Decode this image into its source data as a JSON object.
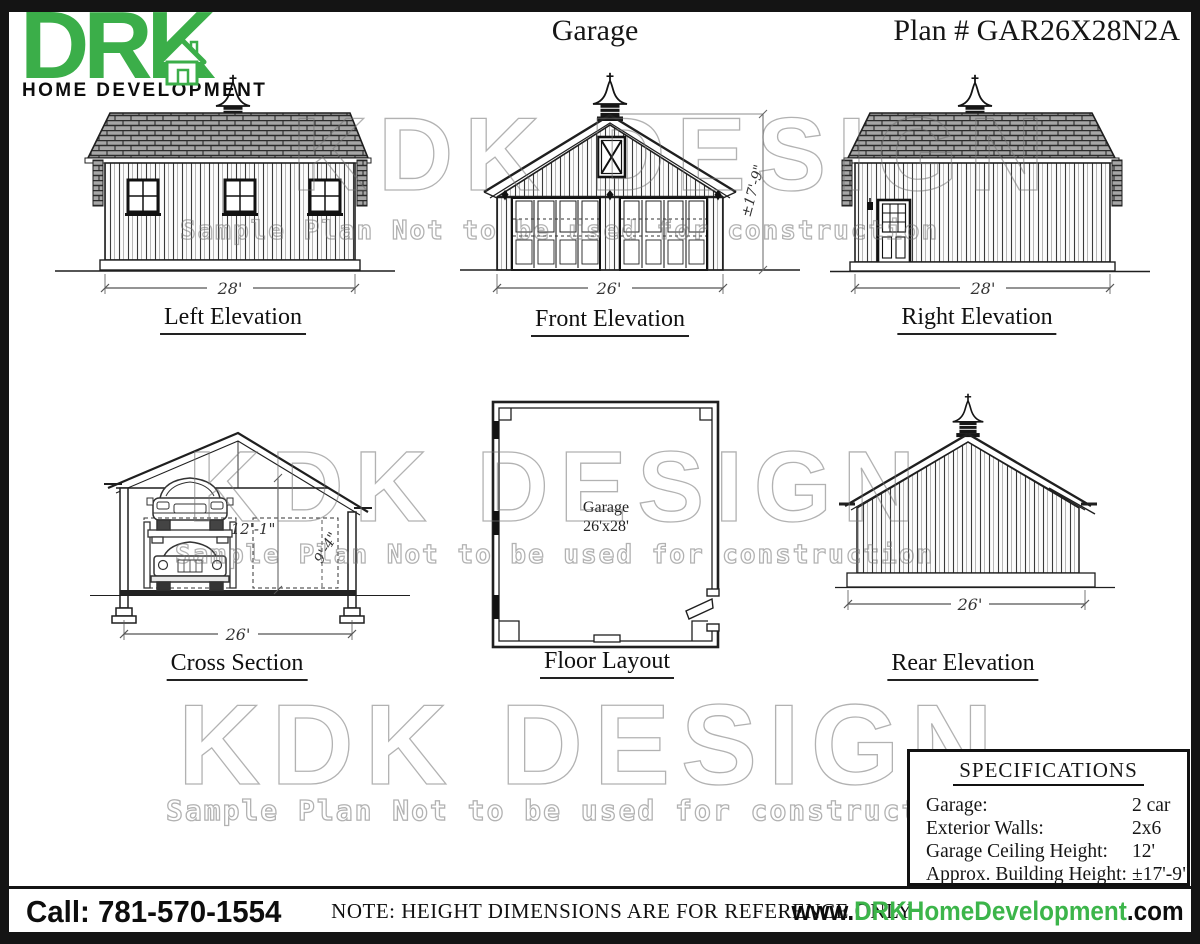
{
  "logo": {
    "brand": "DRK",
    "subtitle": "HOME DEVELOPMENT",
    "green": "#3bae49"
  },
  "header": {
    "title": "Garage",
    "plan_number": "Plan # GAR26X28N2A"
  },
  "watermark": {
    "line1": "KDK DESIGN",
    "line2": "Sample Plan Not to be used for construction"
  },
  "drawings": {
    "left_elevation": {
      "label": "Left Elevation",
      "width_dim": "28'"
    },
    "front_elevation": {
      "label": "Front Elevation",
      "width_dim": "26'",
      "height_dim": "±17'-9\""
    },
    "right_elevation": {
      "label": "Right Elevation",
      "width_dim": "28'"
    },
    "cross_section": {
      "label": "Cross Section",
      "width_dim": "26'",
      "ceiling_dim": "12'-1\"",
      "lift_dim": "9'-4\""
    },
    "floor_layout": {
      "label": "Floor Layout",
      "room_name": "Garage",
      "room_size": "26'x28'"
    },
    "rear_elevation": {
      "label": "Rear Elevation",
      "width_dim": "26'"
    }
  },
  "specifications": {
    "title": "SPECIFICATIONS",
    "rows": [
      {
        "label": "Garage:",
        "value": "2 car"
      },
      {
        "label": "Exterior Walls:",
        "value": "2x6"
      },
      {
        "label": "Garage Ceiling Height:",
        "value": "12'"
      },
      {
        "label": "Approx. Building Height:",
        "value": "±17'-9\""
      }
    ]
  },
  "footer": {
    "phone": "Call: 781-570-1554",
    "note": "NOTE: HEIGHT DIMENSIONS ARE FOR REFERENCE ONLY",
    "website_prefix": "www.",
    "website_brand": "DRKHomeDevelopment",
    "website_suffix": ".com"
  }
}
